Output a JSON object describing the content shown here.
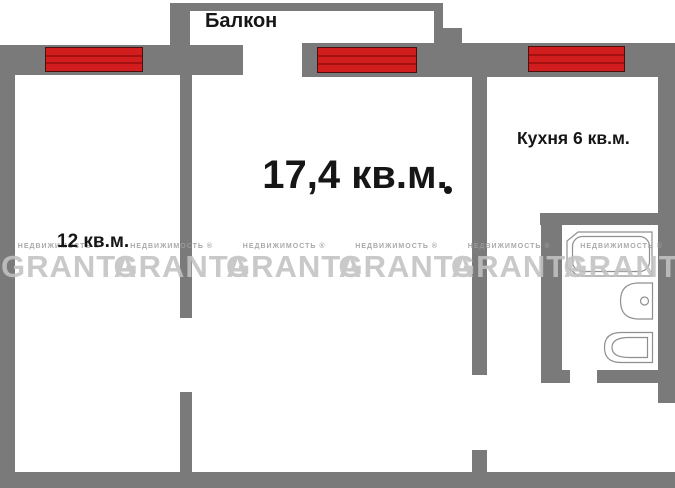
{
  "plan": {
    "balcony_label": "Балкон",
    "rooms": {
      "main": {
        "label": "17,4 кв.м."
      },
      "bedroom": {
        "label": "12 кв.м."
      },
      "kitchen": {
        "label": "Кухня 6 кв.м."
      }
    },
    "fixtures": [
      "bathtub",
      "sink",
      "toilet"
    ],
    "window_count": 3
  },
  "watermark": {
    "brand": "GRANTA",
    "registered": "НЕДВИЖИМОСТЬ ®",
    "repeat": 6
  },
  "colors": {
    "wall": "#7a7a7a",
    "window_fill": "#d11d1d",
    "window_line": "#a31111",
    "window_border": "#4a1010",
    "label_text": "#161616",
    "watermark_brand": "#c2c2c2",
    "watermark_sub": "#9e9e9e",
    "fixture_stroke": "#8f8f8f",
    "background": "#ffffff"
  }
}
